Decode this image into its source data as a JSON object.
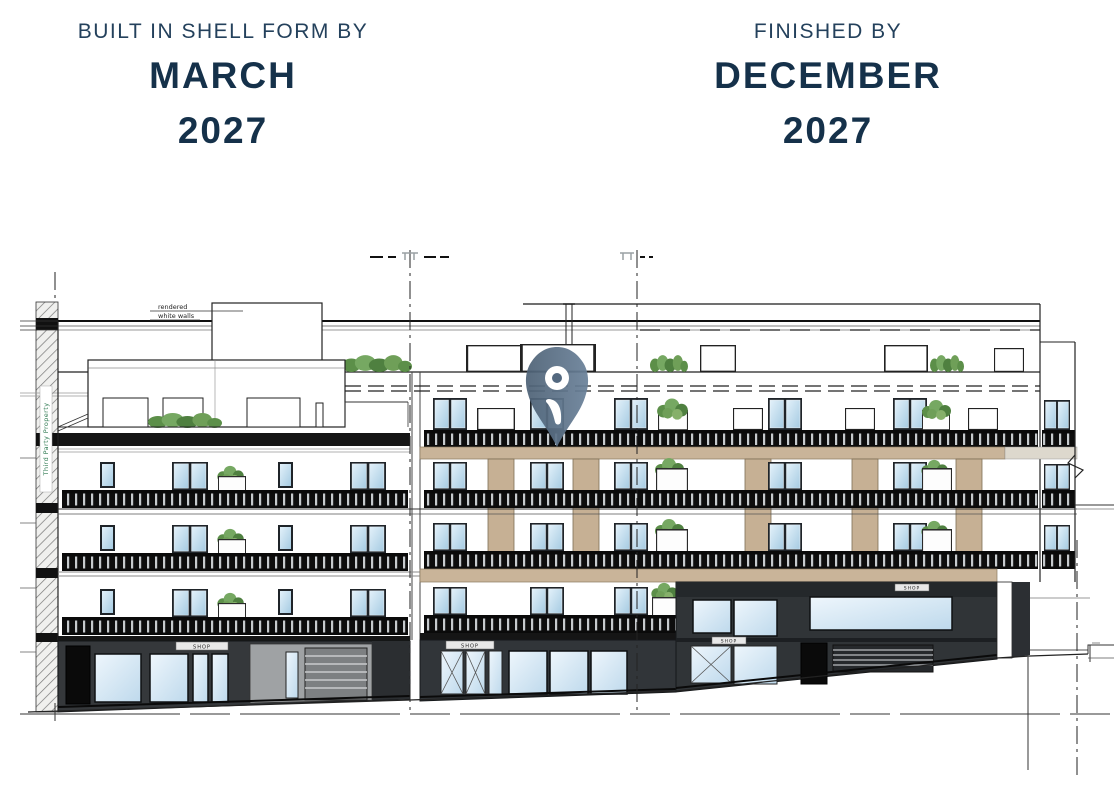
{
  "header": {
    "shell": {
      "label": "BUILT IN SHELL FORM BY",
      "month": "MARCH",
      "year": "2027"
    },
    "finished": {
      "label": "FINISHED BY",
      "month": "DECEMBER",
      "year": "2027"
    }
  },
  "drawing": {
    "notes": {
      "rendered": "rendered",
      "white_walls": "white walls",
      "party_wall": "Third Party Property",
      "shop_sign": "SHOP"
    },
    "icons": {
      "pin": "location-pin-icon"
    }
  },
  "colors": {
    "heading": "#24415c",
    "heading_strong": "#15314a",
    "window_blue": "#bcd9ec",
    "facade_beige": "#c9b499",
    "storefront_dark": "#35383b",
    "railing_black": "#0e0e0e",
    "plant_green": "#6f9f58",
    "pin_slate": "#5a7390",
    "line_ink": "#1a1a1a"
  }
}
